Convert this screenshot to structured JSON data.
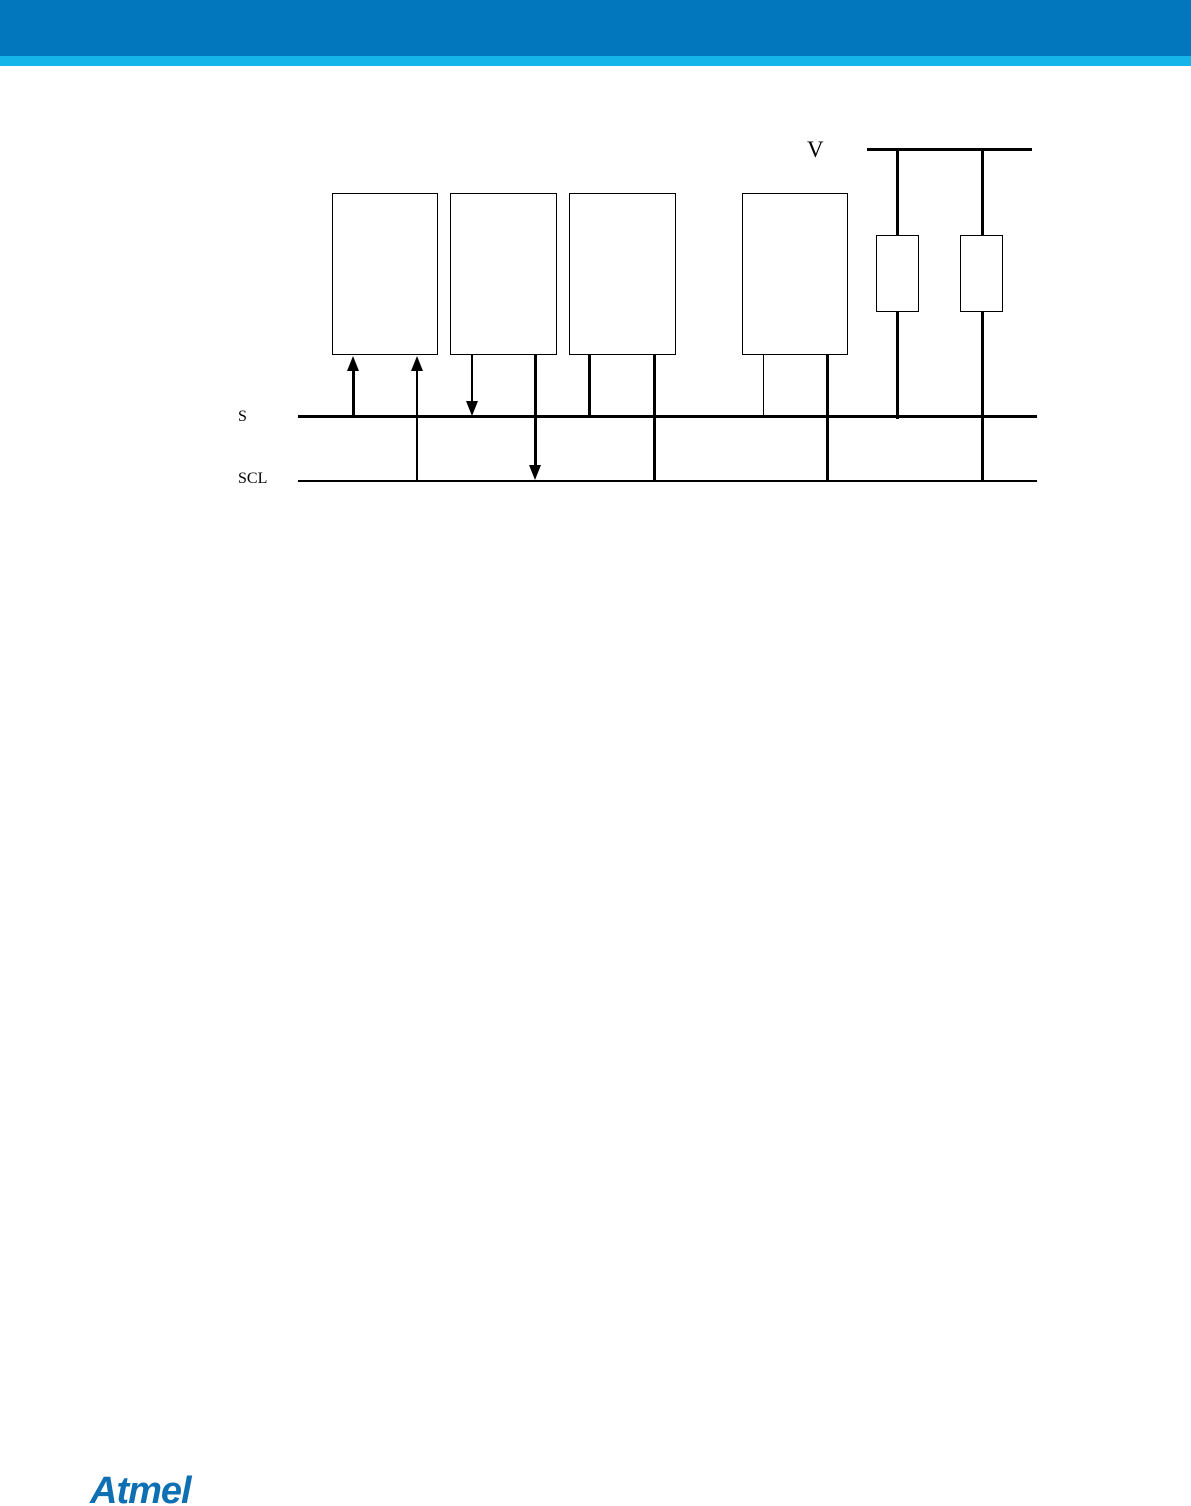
{
  "colors": {
    "header_bar": "#0377bd",
    "header_stripe": "#15b5e9",
    "line": "#000000",
    "logo": "#0e6fb3"
  },
  "diagram": {
    "vcc_label": "V",
    "sda_label": "S",
    "scl_label": "SCL",
    "device_count": 4,
    "pullup_resistor_count": 2
  },
  "footer": {
    "logo_text": "Atmel"
  }
}
